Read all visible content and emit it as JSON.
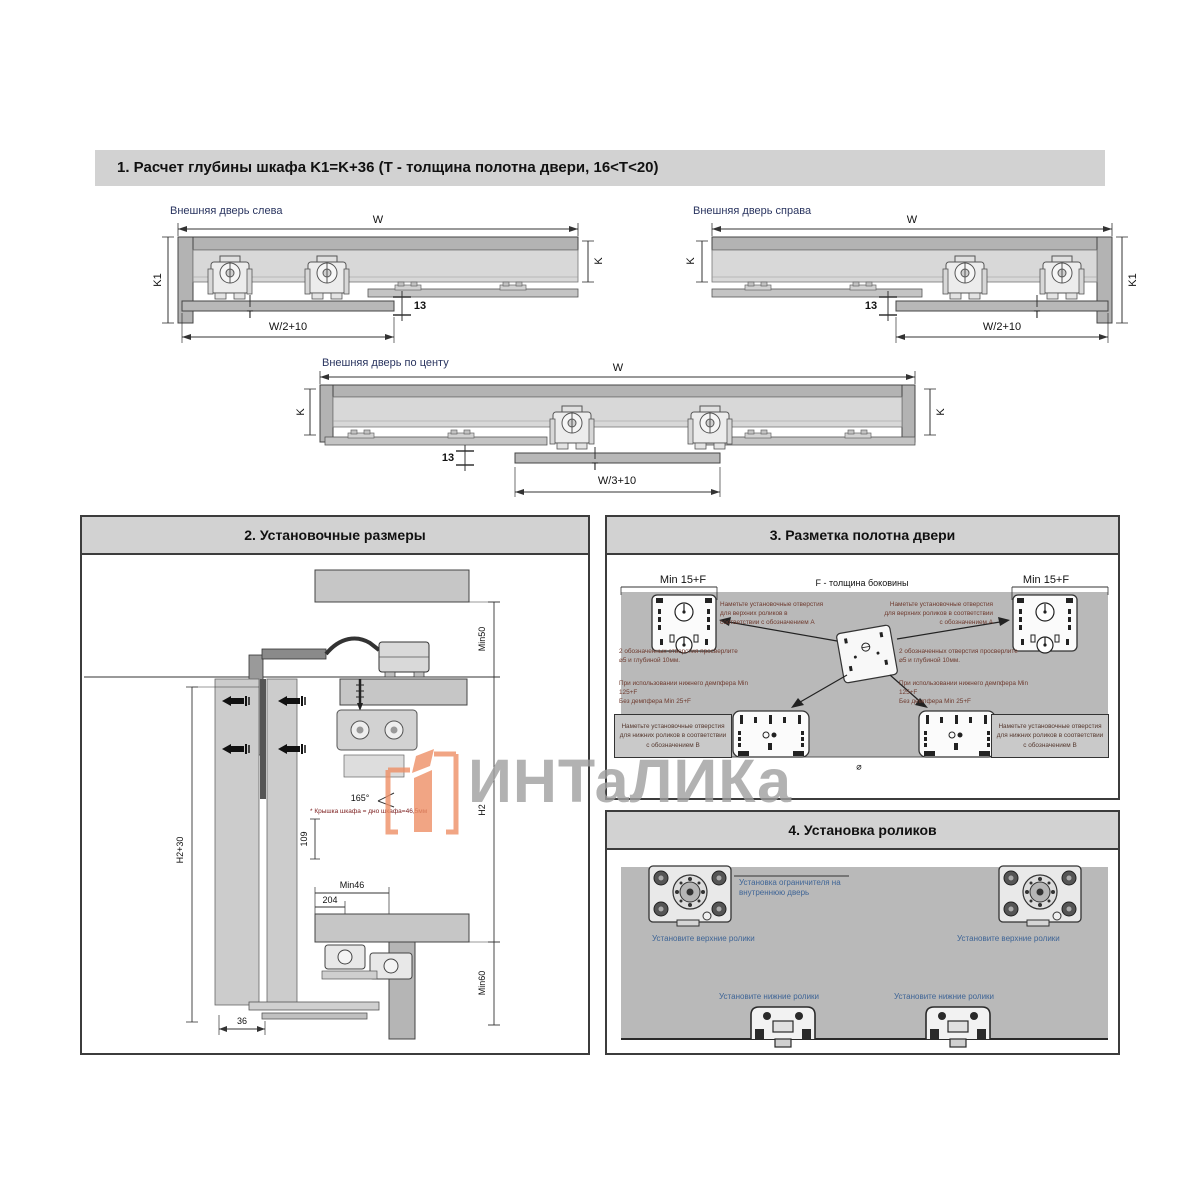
{
  "header1": {
    "title": "1. Расчет глубины шкафа K1=K+36 (Т - толщина полотна двери, 16<Т<20)"
  },
  "diagrams": {
    "left": {
      "label": "Внешняя дверь слева",
      "w": "W",
      "k1": "K1",
      "k": "K",
      "t": "T",
      "bottom": "W/2+10",
      "gap": "13"
    },
    "right": {
      "label": "Внешняя дверь справа",
      "w": "W",
      "k1": "K1",
      "k": "K",
      "t": "T",
      "bottom": "W/2+10",
      "gap": "13"
    },
    "center": {
      "label": "Внешняя дверь по центу",
      "w": "W",
      "k": "K",
      "t": "T",
      "bottom": "W/3+10",
      "gap": "13"
    }
  },
  "section2": {
    "title": "2. Установочные размеры",
    "min50": "Min50",
    "h2p30": "H2+30",
    "h2": "H2",
    "angle": "165°",
    "d109": "109",
    "min46": "Min46",
    "d204": "204",
    "d36": "36",
    "min60": "Min60",
    "footnote": "* Крышка шкафа = дно шкафа=46,5мм"
  },
  "section3": {
    "title": "3. Разметка полотна двери",
    "min15f": "Min 15+F",
    "f_note": "F - толщина боковины",
    "mark_top": "Наметьте установочные отверстия для верхних роликов в соответствии с обозначением А",
    "drill": "2 обозначенных отверстия просверлите ⌀5 и глубиной 10мм.",
    "damper1": "При использовании нижнего демпфера Min 125+F",
    "damper2": "Без демпфера Min 25+F",
    "mark_bottom": "Наметьте установочные отверстия для нижних роликов в соответствии с обозначением В",
    "diameter": "⌀"
  },
  "section4": {
    "title": "4. Установка роликов",
    "limiter": "Установка ограничителя на внутреннюю дверь",
    "upper": "Установите верхние ролики",
    "lower": "Установите нижние ролики"
  },
  "watermark": {
    "text": "ИНТаЛИКа"
  }
}
